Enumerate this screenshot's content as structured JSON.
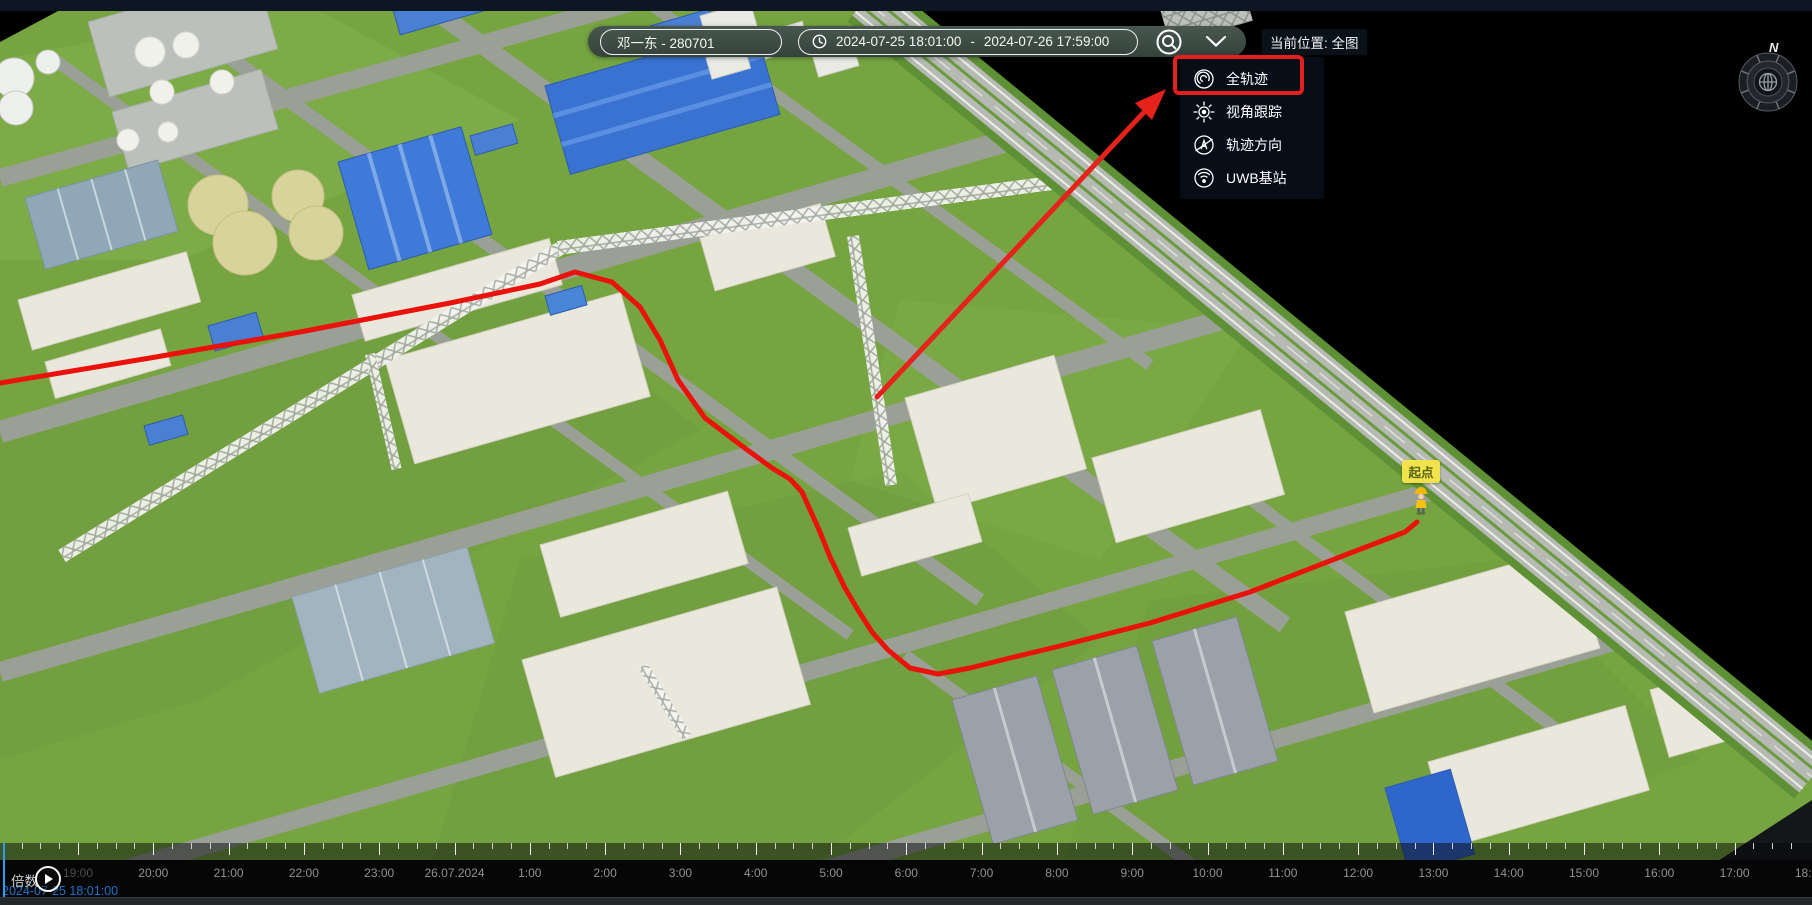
{
  "toolbar": {
    "person": "邓一东 - 280701",
    "time_start": "2024-07-25 18:01:00",
    "time_separator": "-",
    "time_end": "2024-07-26 17:59:00",
    "current_location": "当前位置: 全图"
  },
  "dropdown_menu": {
    "items": [
      {
        "label": "全轨迹",
        "icon": "full-trajectory-icon",
        "highlighted": true
      },
      {
        "label": "视角跟踪",
        "icon": "view-tracking-icon",
        "highlighted": false
      },
      {
        "label": "轨迹方向",
        "icon": "trajectory-direction-icon",
        "highlighted": false
      },
      {
        "label": "UWB基站",
        "icon": "uwb-base-station-icon",
        "highlighted": false
      }
    ]
  },
  "map": {
    "start_point_label": "起点",
    "compass_north_label": "N",
    "trajectory_points": "0,383 150,358 300,332 450,303 540,284 575,272 612,282 640,307 660,340 678,380 705,418 742,446 772,468 790,479 802,492 820,532 830,557 845,588 858,610 872,632 888,650 910,668 938,674 970,668 1010,658 1060,646 1150,623 1250,592 1340,557 1405,532 1417,522",
    "annotation_arrow_points": "877,397 1147,109"
  },
  "timeline": {
    "hour_labels": [
      "19:00",
      "20:00",
      "21:00",
      "22:00",
      "23:00",
      "26.07.2024",
      "1:00",
      "2:00",
      "3:00",
      "4:00",
      "5:00",
      "6:00",
      "7:00",
      "8:00",
      "9:00",
      "10:00",
      "11:00",
      "12:00",
      "13:00",
      "14:00",
      "15:00",
      "16:00",
      "17:00",
      "18:00"
    ],
    "speed_label": "倍数",
    "current_time": "2024-07-25 18:01:00"
  },
  "colors": {
    "accent_red": "#e61e1e",
    "trajectory_red": "#ea120c",
    "playhead_blue": "#2b9df4",
    "timestamp_blue": "#1d74cf",
    "start_label_yellow": "#f2e24b",
    "menu_background": "#0a121e",
    "toolbar_background": "#3d4c45"
  }
}
